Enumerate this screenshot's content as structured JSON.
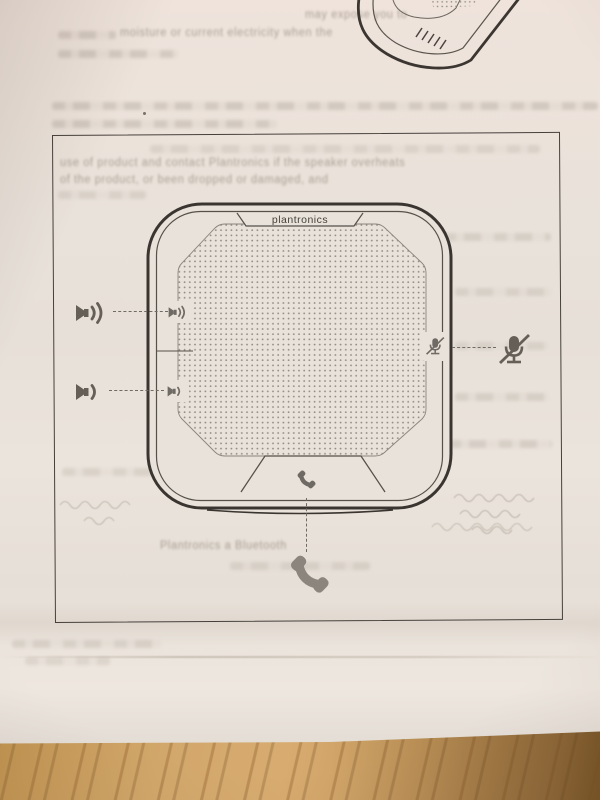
{
  "device": {
    "brand_label": "plantronics",
    "callouts": [
      {
        "id": "volume-up",
        "icon": "speaker-with-two-sound-waves"
      },
      {
        "id": "volume-down",
        "icon": "speaker-with-one-sound-wave"
      },
      {
        "id": "mute",
        "icon": "microphone-with-slash"
      },
      {
        "id": "call",
        "icon": "phone-handset"
      }
    ]
  },
  "bleedthrough_text": {
    "line1": "may expose you to",
    "line2": "moisture or current electricity when the",
    "line3": "use of product and contact Plantronics if the speaker overheats",
    "line4": "of the product, or been dropped or damaged, and",
    "line5": "Plantronics a Bluetooth"
  },
  "colors": {
    "paper": "#eae3db",
    "ink_outline": "#3b3631",
    "icon_gray": "#655f58",
    "phone_icon_gray": "#8b857e",
    "desk_wood": "#c9995f",
    "faint_print": "#7a7064"
  }
}
